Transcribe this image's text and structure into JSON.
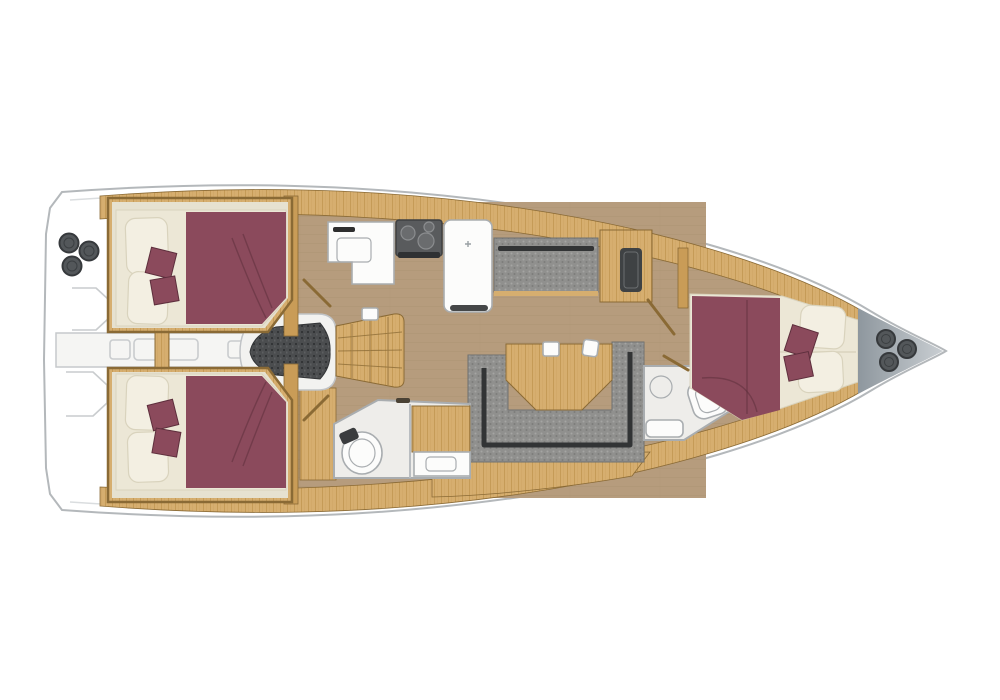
{
  "canvas": {
    "width": 1000,
    "height": 700
  },
  "diagram": {
    "kind": "yacht interior floor plan, top-down view",
    "bow_direction": "right",
    "visible_text": [],
    "components": [
      "hull",
      "stern-swim-platform",
      "stern-winches",
      "aft-walkthrough-corridor",
      "engine-compartment",
      "companionway-stairs",
      "aft-cabin-port",
      "aft-cabin-starboard",
      "galley-sink-counter",
      "galley-stove",
      "galley-refrigerator-peninsula",
      "saloon-settee",
      "storage-cabinet",
      "saloon-floor",
      "dinette-u-sofa",
      "dinette-table",
      "aft-head-toilet",
      "aft-head-sink-counter",
      "forward-head-toilet",
      "forward-head-sink",
      "shower-tray",
      "forward-cabin-v-berth",
      "bow-foredeck-fittings",
      "side-deck-top",
      "side-deck-bottom",
      "cabin-doors"
    ]
  },
  "colors": {
    "hull_fill": "#ffffff",
    "hull_outline": "#b4b8bb",
    "hull_inner": "#dadddf",
    "bow_metal_light": "#c9ced2",
    "bow_metal_dark": "#8e979e",
    "winch": "#53575a",
    "winch_ring": "#36393c",
    "deck_wood": "#d6ae6f",
    "deck_wood_line": "#b3873f",
    "wall_wood": "#c99c57",
    "wall_wood_dark": "#8a6a35",
    "floor_main": "#b69c7d",
    "floor_main_line": "#a78d6e",
    "cabin_base": "#e6e1d0",
    "mattress": "#ece7d6",
    "pillow": "#f3efe2",
    "pillow_edge": "#d9d3bd",
    "bed": "#8b4a5c",
    "bed_dark": "#5e2f3d",
    "gray_uphol": "#90908e",
    "gray_uphol_dot": "#a5a5a3",
    "gray_uphol_dot2": "#7d7d7b",
    "uphol_dark": "#323435",
    "engine": "#4b4d4f",
    "engine_dark": "#333537",
    "white_fix": "#fcfcfb",
    "fix_edge": "#a9adb0",
    "room_floor": "#eeedea"
  }
}
